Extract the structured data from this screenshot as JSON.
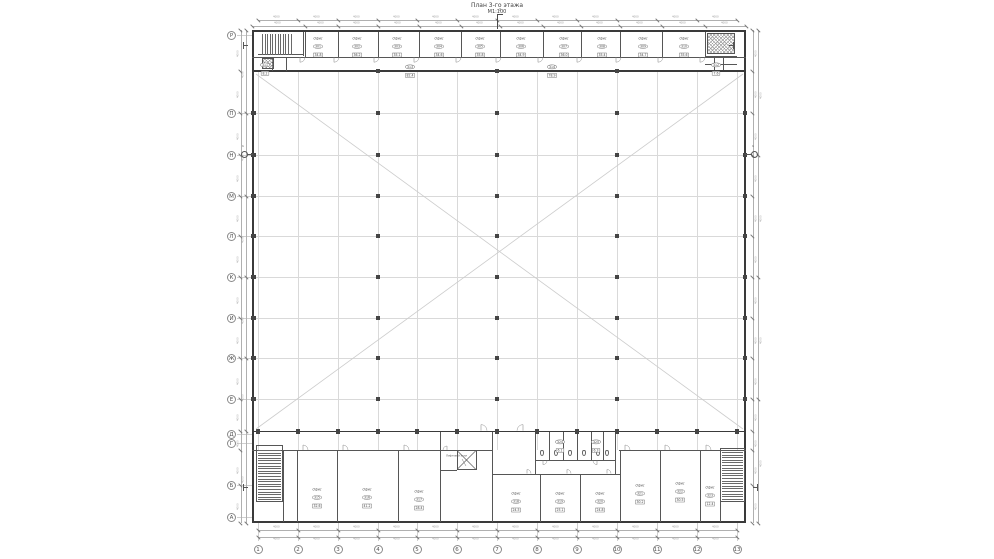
{
  "title": {
    "line1": "План 3-го этажа",
    "line2": "М1:100"
  },
  "palette": {
    "paper": "#ffffff",
    "wall": "#3a3a3a",
    "grid_light": "#d9d9d9",
    "diagonal": "#cccccc",
    "column": "#454545",
    "text": "#4a4a4a",
    "dim": "#9a9a9a",
    "tick": "#777777",
    "chain": "#b0b0b0",
    "ext": "#cfcfcf"
  },
  "geometry": {
    "outline": {
      "x": 252,
      "y": 30,
      "w": 494,
      "h": 493
    },
    "hall": {
      "x1": 253,
      "y1": 72,
      "x2": 745,
      "y2": 431
    },
    "axis_x": [
      258,
      298,
      338,
      378,
      417,
      457,
      497,
      537,
      577,
      617,
      657,
      697,
      737
    ],
    "row_y": [
      113,
      155,
      196,
      236,
      277,
      318,
      358,
      399
    ],
    "interior_col_x": [
      378,
      497,
      617
    ],
    "walls_heavy": [
      [
        252,
        30,
        494,
        1.6
      ],
      [
        252,
        30,
        1.6,
        493
      ],
      [
        744.4,
        30,
        1.6,
        493
      ],
      [
        252,
        521.4,
        494,
        1.6
      ],
      [
        252,
        70,
        494,
        1.8
      ],
      [
        252,
        430.6,
        494,
        1.8
      ]
    ],
    "walls_thin": [
      [
        252,
        56.5,
        494,
        0.7
      ],
      [
        305,
        32,
        0.7,
        24.5
      ],
      [
        338,
        32,
        0.7,
        24.5
      ],
      [
        378,
        32,
        0.7,
        24.5
      ],
      [
        419,
        32,
        0.7,
        24.5
      ],
      [
        461,
        32,
        0.7,
        24.5
      ],
      [
        500,
        32,
        0.7,
        24.5
      ],
      [
        543,
        32,
        0.7,
        24.5
      ],
      [
        581,
        32,
        0.7,
        24.5
      ],
      [
        620,
        32,
        0.7,
        24.5
      ],
      [
        662,
        32,
        0.7,
        24.5
      ],
      [
        705,
        32,
        0.7,
        24.5
      ],
      [
        303,
        32,
        0.7,
        24
      ],
      [
        258,
        54,
        45.7,
        0.7
      ],
      [
        272,
        56.5,
        0.7,
        14
      ],
      [
        286,
        56.5,
        0.7,
        14
      ],
      [
        705,
        55.8,
        32,
        0.7
      ],
      [
        714,
        56,
        0.7,
        14
      ],
      [
        723,
        56,
        0.7,
        14
      ],
      [
        705,
        63.5,
        32,
        0.7
      ],
      [
        252,
        450,
        241,
        0.7
      ],
      [
        492,
        473.5,
        129,
        0.7
      ],
      [
        619,
        450,
        127,
        0.7
      ],
      [
        283,
        450,
        0.7,
        71.5
      ],
      [
        297,
        450,
        0.7,
        71.5
      ],
      [
        337,
        450,
        0.7,
        71.5
      ],
      [
        398,
        450,
        0.7,
        71.5
      ],
      [
        440,
        450,
        0.7,
        71.5
      ],
      [
        492,
        450,
        0.7,
        71.5
      ],
      [
        620,
        450,
        0.7,
        71.5
      ],
      [
        660,
        450,
        0.7,
        71.5
      ],
      [
        700,
        450,
        0.7,
        71.5
      ],
      [
        720,
        450,
        0.7,
        71.5
      ],
      [
        540,
        474,
        0.7,
        47.5
      ],
      [
        580,
        474,
        0.7,
        47.5
      ],
      [
        440,
        432,
        0.7,
        18.5
      ],
      [
        492,
        432,
        0.7,
        42
      ],
      [
        535,
        432,
        0.7,
        42
      ],
      [
        615,
        432,
        0.7,
        42
      ],
      [
        535,
        460,
        80.7,
        0.7
      ],
      [
        549,
        432,
        0.7,
        28
      ],
      [
        563,
        432,
        0.7,
        28
      ],
      [
        577,
        432,
        0.7,
        28
      ],
      [
        591,
        432,
        0.7,
        28
      ],
      [
        603,
        432,
        0.7,
        28
      ],
      [
        456.8,
        450,
        19.4,
        0.7
      ],
      [
        456.8,
        469,
        19.4,
        0.7
      ],
      [
        456.8,
        450,
        0.7,
        19.7
      ],
      [
        475.5,
        450,
        0.7,
        19.7
      ],
      [
        440,
        470,
        17,
        0.7
      ],
      [
        256,
        445,
        27,
        0.7
      ],
      [
        256,
        445,
        0.7,
        57
      ],
      [
        282.3,
        445,
        0.7,
        57
      ],
      [
        256,
        501.3,
        27,
        0.7
      ],
      [
        720,
        448,
        25,
        0.7
      ],
      [
        720,
        448,
        0.7,
        54
      ],
      [
        744.3,
        448,
        0.7,
        54
      ],
      [
        720,
        501.3,
        25,
        0.7
      ]
    ],
    "stair_treads": [
      {
        "x": 262,
        "y": 34,
        "w": 30,
        "h": 21,
        "dir": "v",
        "step": 2.6
      },
      {
        "x": 258,
        "y": 450,
        "w": 23,
        "h": 50,
        "dir": "h",
        "step": 2.6
      },
      {
        "x": 722,
        "y": 452,
        "w": 21,
        "h": 48,
        "dir": "h",
        "step": 2.6
      }
    ],
    "crosshatch": [
      {
        "x": 707,
        "y": 33,
        "w": 28,
        "h": 21
      },
      {
        "x": 262,
        "y": 57.5,
        "w": 12,
        "h": 11
      }
    ],
    "elevator": {
      "x": 457,
      "y": 450.5,
      "w": 19,
      "h": 19
    },
    "wc_fixtures": [
      [
        540,
        450
      ],
      [
        554,
        450
      ],
      [
        568,
        450
      ],
      [
        582,
        450
      ],
      [
        596,
        450
      ],
      [
        605,
        450
      ]
    ],
    "diagonals": [
      [
        256,
        74,
        743,
        429
      ],
      [
        743,
        74,
        256,
        429
      ]
    ],
    "doors": [
      [
        300,
        57.2,
        5,
        1,
        1
      ],
      [
        334,
        57.2,
        5,
        1,
        1
      ],
      [
        374,
        57.2,
        5,
        1,
        1
      ],
      [
        414,
        57.2,
        5,
        1,
        1
      ],
      [
        456,
        57.2,
        5,
        1,
        1
      ],
      [
        496,
        57.2,
        5,
        1,
        1
      ],
      [
        538,
        57.2,
        5,
        1,
        1
      ],
      [
        577,
        57.2,
        5,
        1,
        1
      ],
      [
        616,
        57.2,
        5,
        1,
        1
      ],
      [
        658,
        57.2,
        5,
        1,
        1
      ],
      [
        700,
        57.2,
        5,
        1,
        1
      ],
      [
        303,
        450,
        5,
        1,
        -1
      ],
      [
        343,
        450,
        5,
        1,
        -1
      ],
      [
        404,
        450,
        5,
        1,
        -1
      ],
      [
        625,
        450,
        5,
        1,
        -1
      ],
      [
        665,
        450,
        5,
        1,
        -1
      ],
      [
        706,
        450,
        5,
        1,
        -1
      ],
      [
        527,
        473.5,
        4,
        1,
        -1
      ],
      [
        567,
        473.5,
        4,
        1,
        -1
      ],
      [
        607,
        473.5,
        4,
        1,
        -1
      ],
      [
        481,
        430.6,
        6,
        1,
        -1
      ],
      [
        523,
        430.6,
        6,
        -1,
        -1
      ],
      [
        447,
        450,
        4,
        -1,
        -1
      ],
      [
        543,
        460.6,
        4,
        1,
        1
      ],
      [
        597,
        460.6,
        4,
        -1,
        1
      ]
    ]
  },
  "axes": {
    "bottom": {
      "y": 545,
      "cy": 549.5,
      "labels": [
        "1",
        "2",
        "3",
        "4",
        "5",
        "6",
        "7",
        "8",
        "9",
        "10",
        "11",
        "12",
        "13"
      ]
    },
    "left": {
      "x": 227,
      "items": [
        [
          35,
          "Р"
        ],
        [
          113,
          "П"
        ],
        [
          155,
          "Н"
        ],
        [
          196,
          "М"
        ],
        [
          236,
          "Л"
        ],
        [
          277,
          "К"
        ],
        [
          318,
          "И"
        ],
        [
          358,
          "Ж"
        ],
        [
          399,
          "Е"
        ],
        [
          434,
          "Д"
        ],
        [
          443,
          "Г"
        ],
        [
          485,
          "Б"
        ],
        [
          517,
          "А"
        ]
      ]
    }
  },
  "dims": {
    "label": "4000",
    "top": [
      {
        "y": 20,
        "nodes": [
          258,
          298,
          338,
          378,
          417,
          457,
          497,
          537,
          577,
          617,
          657,
          697,
          737
        ]
      },
      {
        "y": 25.5,
        "nodes": [
          252,
          305,
          338,
          378,
          419,
          461,
          500,
          543,
          581,
          620,
          662,
          705,
          746
        ]
      }
    ],
    "bottom": [
      {
        "y": 530,
        "nodes": [
          258,
          298,
          338,
          378,
          417,
          457,
          497,
          537,
          577,
          617,
          657,
          697,
          737
        ]
      },
      {
        "y": 536.5,
        "nodes": [
          258,
          298,
          338,
          378,
          417,
          457,
          497,
          537,
          577,
          617,
          657,
          697,
          737
        ]
      }
    ],
    "left": [
      {
        "x": 240.5,
        "nodes": [
          30,
          71,
          113,
          155,
          196,
          236,
          277,
          318,
          358,
          399,
          431,
          450,
          485,
          523
        ]
      },
      {
        "x": 246,
        "nodes": [
          30,
          113,
          196,
          277,
          358,
          431,
          523
        ]
      }
    ],
    "right": [
      {
        "x": 752.5,
        "nodes": [
          30,
          71,
          113,
          155,
          196,
          236,
          277,
          318,
          358,
          399,
          431,
          450,
          485,
          523
        ]
      },
      {
        "x": 758,
        "nodes": [
          30,
          155,
          277,
          399,
          523
        ]
      }
    ]
  },
  "tags": [
    {
      "x": 318,
      "y": 37,
      "name": "Офис",
      "num": "301",
      "area": "34.8"
    },
    {
      "x": 357,
      "y": 37,
      "name": "Офис",
      "num": "302",
      "area": "36.2"
    },
    {
      "x": 397,
      "y": 37,
      "name": "Офис",
      "num": "303",
      "area": "35.1"
    },
    {
      "x": 439,
      "y": 37,
      "name": "Офис",
      "num": "304",
      "area": "34.6"
    },
    {
      "x": 480,
      "y": 37,
      "name": "Офис",
      "num": "305",
      "area": "35.8"
    },
    {
      "x": 521,
      "y": 37,
      "name": "Офис",
      "num": "306",
      "area": "34.9"
    },
    {
      "x": 564,
      "y": 37,
      "name": "Офис",
      "num": "307",
      "area": "36.0"
    },
    {
      "x": 602,
      "y": 37,
      "name": "Офис",
      "num": "308",
      "area": "35.4"
    },
    {
      "x": 643,
      "y": 37,
      "name": "Офис",
      "num": "309",
      "area": "34.7"
    },
    {
      "x": 684,
      "y": 37,
      "name": "Офис",
      "num": "310",
      "area": "35.6"
    },
    {
      "x": 265,
      "y": 59,
      "num": "311",
      "area": "8.2",
      "small": true
    },
    {
      "x": 716,
      "y": 59,
      "num": "312",
      "area": "7.6",
      "small": true
    },
    {
      "x": 410,
      "y": 61,
      "num": "313",
      "area": "82.4",
      "small": true
    },
    {
      "x": 552,
      "y": 61,
      "num": "314",
      "area": "78.9",
      "small": true
    },
    {
      "x": 317,
      "y": 488,
      "name": "Офис",
      "num": "315",
      "area": "32.6"
    },
    {
      "x": 367,
      "y": 488,
      "name": "Офис",
      "num": "316",
      "area": "41.2"
    },
    {
      "x": 419,
      "y": 490,
      "name": "Офис",
      "num": "317",
      "area": "28.4"
    },
    {
      "x": 516,
      "y": 492,
      "name": "Офис",
      "num": "318",
      "area": "24.5"
    },
    {
      "x": 560,
      "y": 492,
      "name": "Офис",
      "num": "319",
      "area": "25.1"
    },
    {
      "x": 600,
      "y": 492,
      "name": "Офис",
      "num": "320",
      "area": "24.8"
    },
    {
      "x": 640,
      "y": 484,
      "name": "Офис",
      "num": "321",
      "area": "30.2"
    },
    {
      "x": 680,
      "y": 482,
      "name": "Офис",
      "num": "322",
      "area": "30.5"
    },
    {
      "x": 710,
      "y": 486,
      "name": "Офис",
      "num": "323",
      "area": "12.4"
    },
    {
      "x": 560,
      "y": 436,
      "num": "324",
      "area": "6.1",
      "small": true
    },
    {
      "x": 596,
      "y": 436,
      "num": "325",
      "area": "6.3",
      "small": true
    }
  ],
  "leader": {
    "text": "Лифтовой холл",
    "tx": 446,
    "ty": 455,
    "x1": 462,
    "y1": 459,
    "x2": 466,
    "y2": 466
  },
  "sections": [
    {
      "label": "2",
      "x": 497,
      "y": 12,
      "type": "top"
    },
    {
      "label": "1",
      "x": 244,
      "y": 154,
      "type": "left"
    },
    {
      "label": "1",
      "x": 754,
      "y": 154,
      "type": "right"
    }
  ],
  "corner_flags": [
    [
      243,
      45,
      1
    ],
    [
      243,
      487,
      1
    ],
    [
      757,
      487,
      -1
    ],
    [
      733,
      45,
      -1
    ]
  ]
}
